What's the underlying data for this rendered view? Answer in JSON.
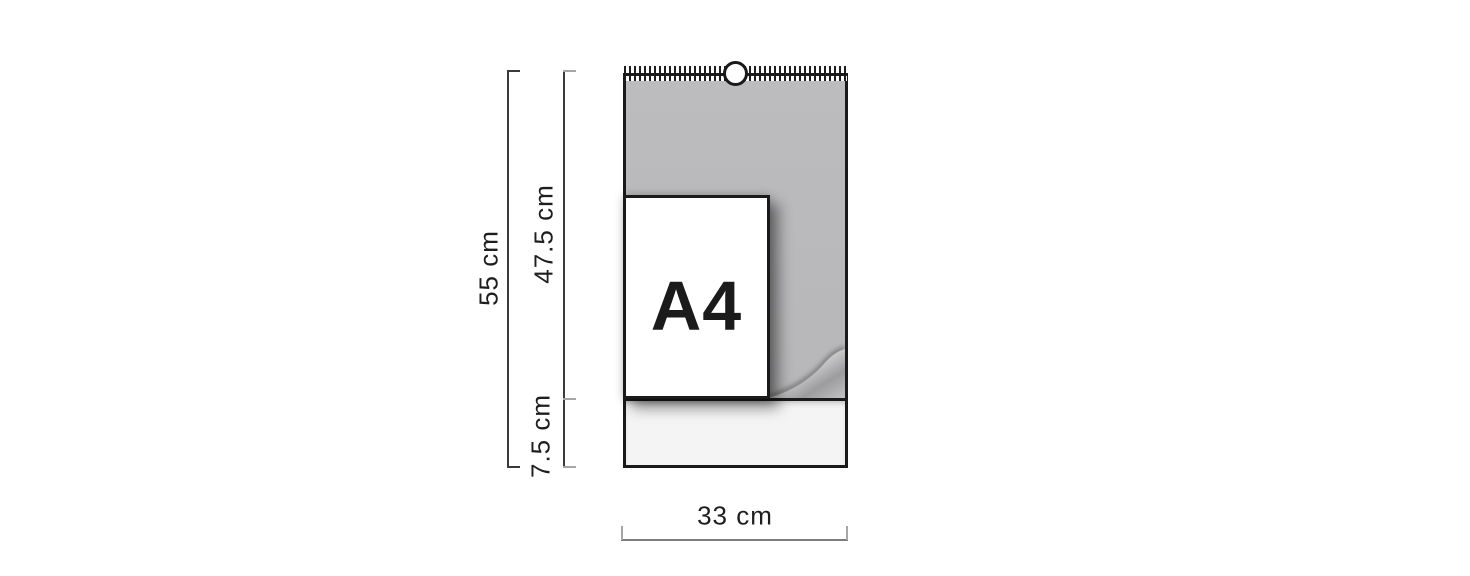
{
  "diagram": {
    "product_label": "A4",
    "dimensions": {
      "total_height": "55 cm",
      "page_height": "47.5 cm",
      "footer_height": "7.5 cm",
      "width": "33 cm"
    }
  },
  "colors": {
    "page-gray": "#b9b9bb",
    "footer-light": "#f4f4f4",
    "outline": "#1a1a1a",
    "dim-dark": "#3a3a3a",
    "dim-light": "#a6a6a6",
    "text": "#1e1e1e",
    "background": "#ffffff"
  }
}
